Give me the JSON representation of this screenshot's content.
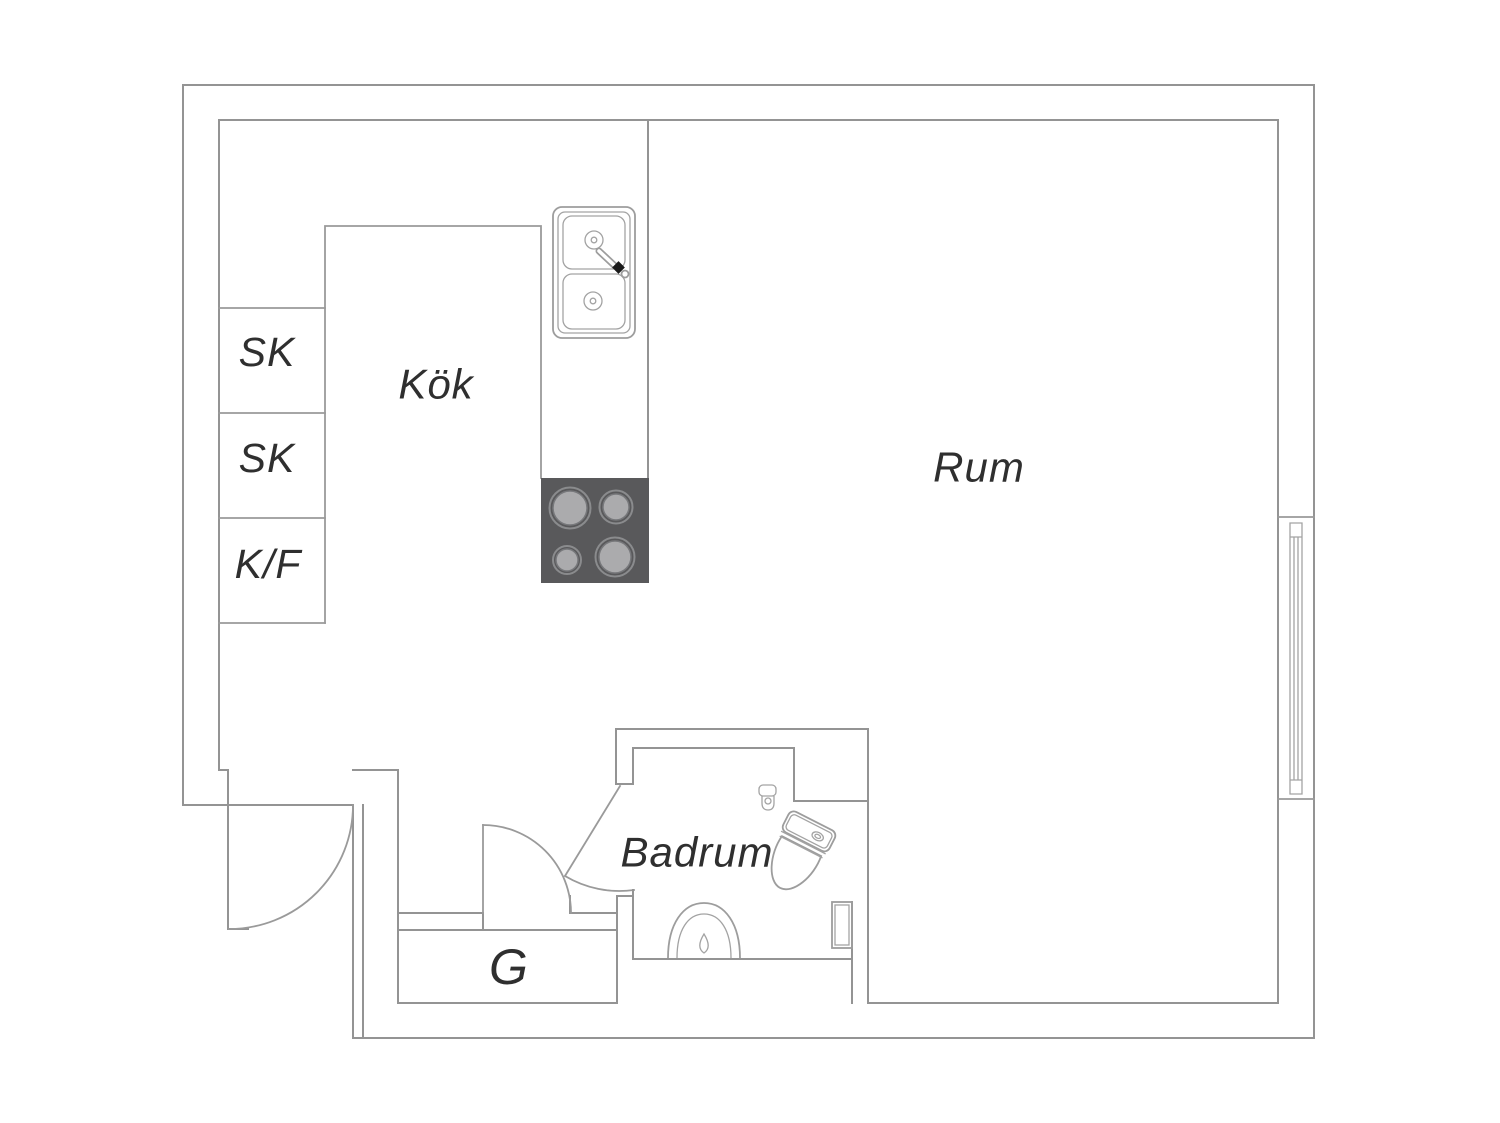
{
  "floorplan": {
    "labels": {
      "kitchen": "Kök",
      "room": "Rum",
      "bathroom": "Badrum",
      "closet": "G",
      "cabinet_1": "SK",
      "cabinet_2": "SK",
      "fridge_freezer": "K/F"
    },
    "colors": {
      "background": "#ffffff",
      "wall_line": "#949494",
      "fixture_line": "#9d9d9d",
      "label_text": "#2f2f2f",
      "stove_top": "#59595b",
      "burner": "#ababad",
      "burner_ring": "#86878a",
      "faucet_black": "#1a1a1a"
    }
  }
}
